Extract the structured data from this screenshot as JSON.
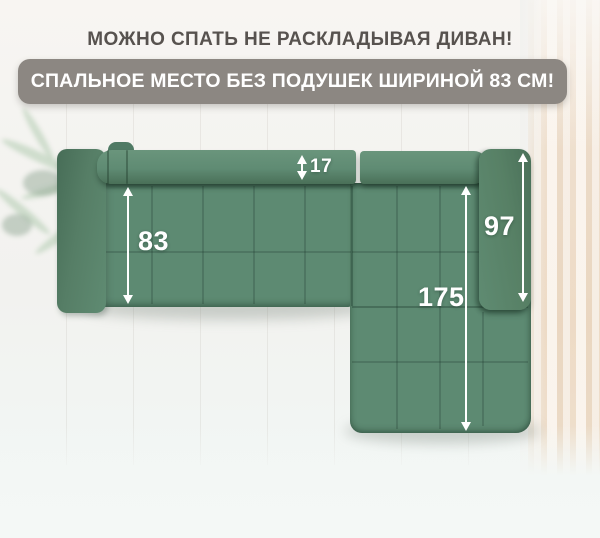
{
  "headline": {
    "text": "МОЖНО СПАТЬ НЕ РАСКЛАДЫВАЯ ДИВАН!"
  },
  "badge": {
    "text": "СПАЛЬНОЕ МЕСТО БЕЗ ПОДУШЕК ШИРИНОЙ 83 СМ!"
  },
  "diagram": {
    "description": "top view of green L-shaped corner sofa with sleeping-area dimensions",
    "dimensions": [
      {
        "id": "backrest-depth",
        "value": "17"
      },
      {
        "id": "sleeping-width",
        "value": "83"
      },
      {
        "id": "right-armrest-length",
        "value": "97"
      },
      {
        "id": "chaise-length",
        "value": "175"
      }
    ]
  },
  "colors": {
    "sofa_green": "#5d8a72",
    "sofa_green_dark": "#48705a",
    "badge_background": "#8c8782",
    "headline_text": "#57524f",
    "dimension_text": "#ffffff",
    "curtain_beige": "#f1e1cd"
  }
}
